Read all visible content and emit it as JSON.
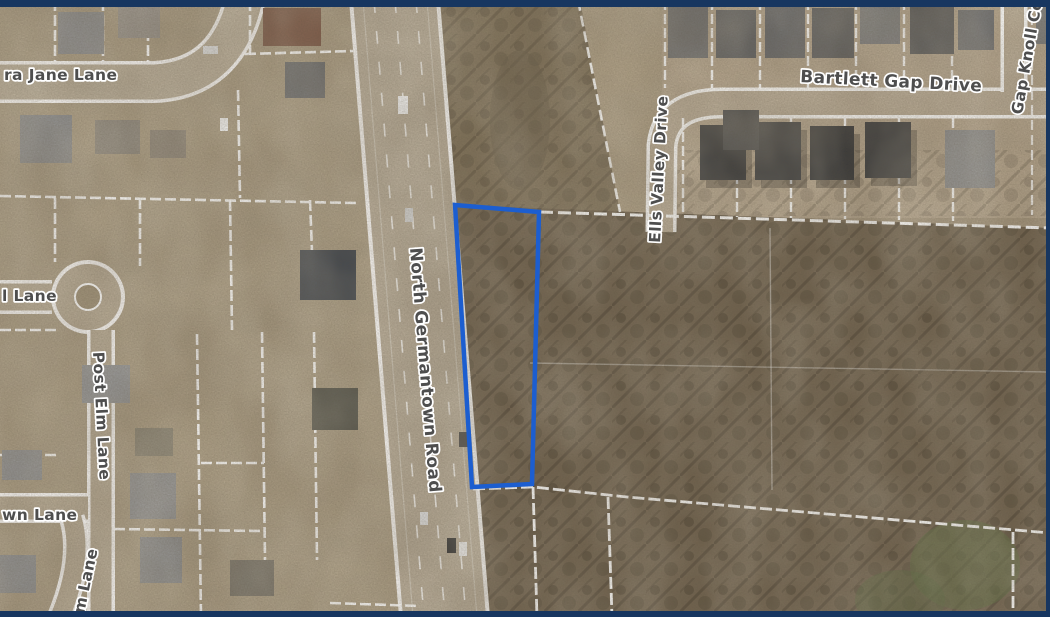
{
  "map": {
    "description": "aerial parcel map with highlighted lot",
    "frame_color": "#173660",
    "labels": {
      "jane_lane": "ra Jane Lane",
      "bartlett_gap": "Bartlett Gap Drive",
      "gap_knoll": "Gap Knoll Cove",
      "ells_valley": "Ells Valley Drive",
      "n_germantown": "North Germantown Road",
      "post_elm": "Post Elm Lane",
      "lane_left": "l Lane",
      "lane_bottom": "wn Lane",
      "lane_bottom_vertical": "m Lane"
    },
    "highlight": {
      "parcel_outline_color": "#1c5ed0"
    }
  }
}
